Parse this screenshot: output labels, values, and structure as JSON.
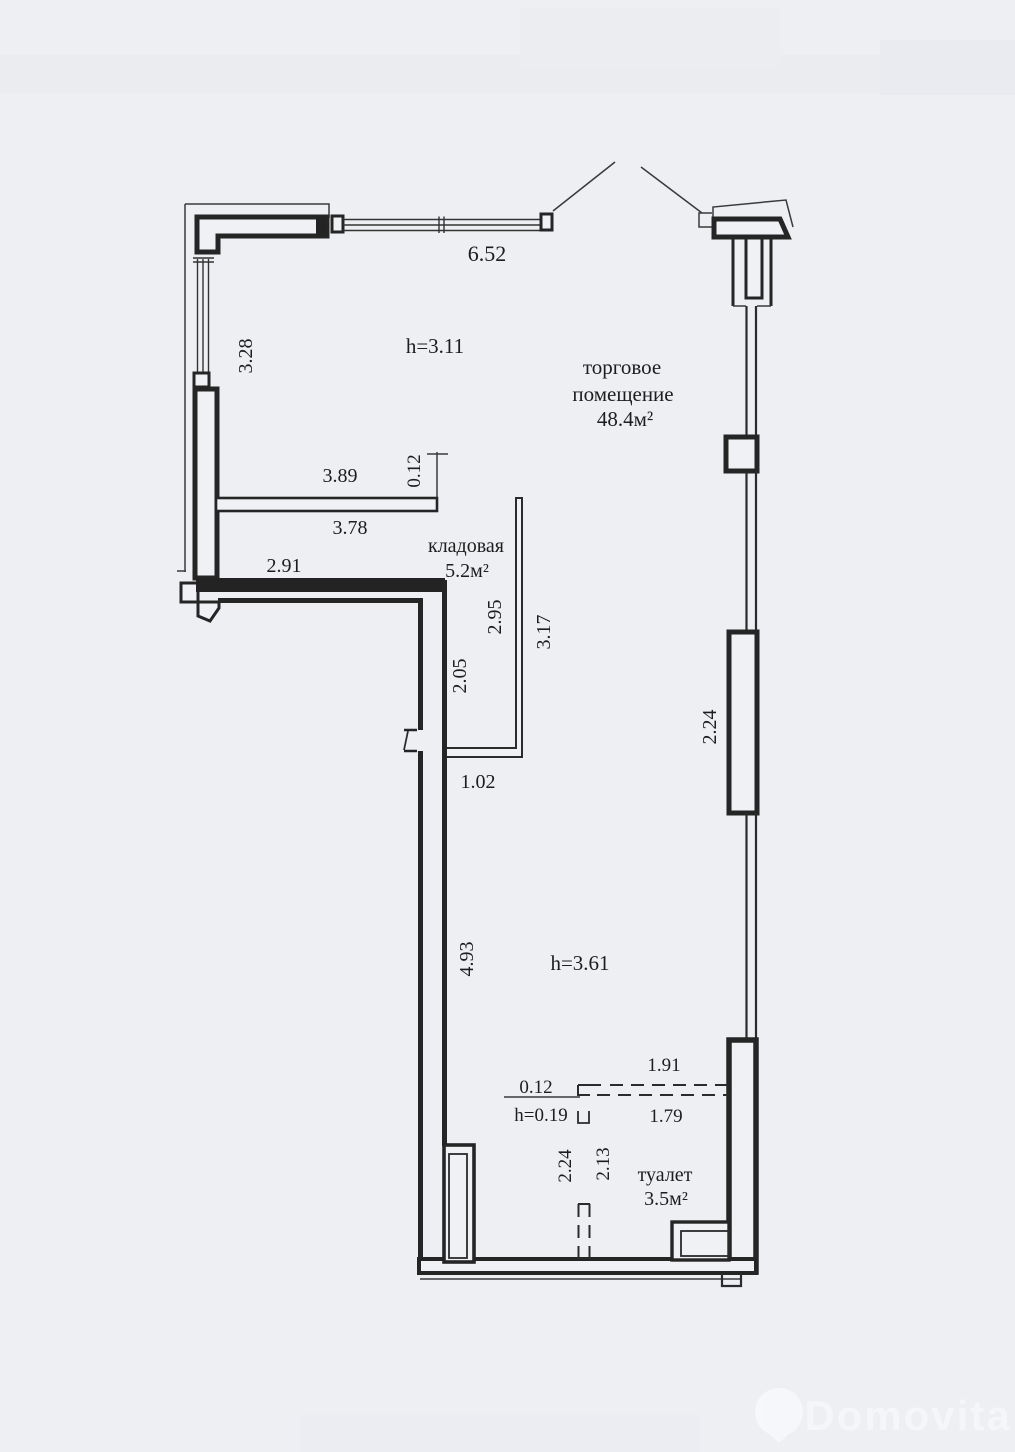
{
  "page": {
    "background": "#edeff3",
    "line_color": "#252525",
    "watermark_color": "#f7f8fb"
  },
  "rooms": {
    "trade": {
      "name_line1": "торговое",
      "name_line2": "помещение",
      "area": "48.4м²",
      "ceiling_height_upper": "h=3.11",
      "ceiling_height_lower": "h=3.61"
    },
    "storage": {
      "name": "кладовая",
      "area": "5.2м²"
    },
    "toilet": {
      "name": "туалет",
      "area": "3.5м²"
    }
  },
  "dimensions": {
    "top_window": "6.52",
    "left_window": "3.28",
    "partition_top": "3.89",
    "partition_thickness": "0.12",
    "partition_bottom": "3.78",
    "wall_left_lower": "2.91",
    "storage_inner_height": "2.95",
    "storage_outer_height": "3.17",
    "storage_west_side": "2.05",
    "storage_opening": "1.02",
    "right_pilaster": "2.24",
    "corridor_wall": "4.93",
    "low_wall_top": "1.91",
    "low_wall_bottom": "1.79",
    "low_wall_thickness": "0.12",
    "low_wall_height": "h=0.19",
    "toilet_outer": "2.24",
    "toilet_inner": "2.13"
  },
  "watermark": {
    "brand": "Domovita"
  }
}
